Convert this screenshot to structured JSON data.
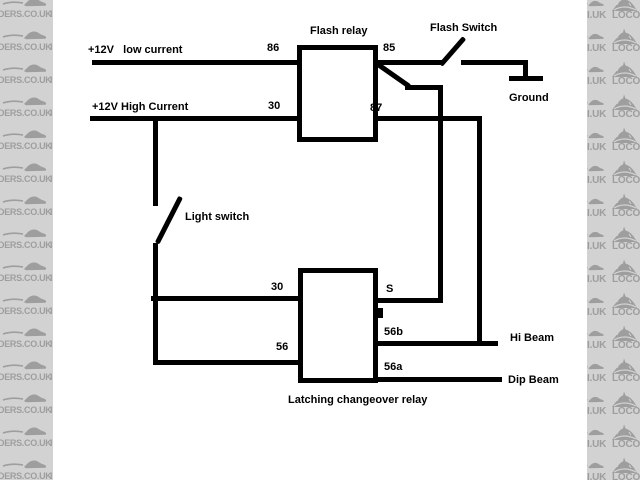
{
  "watermark": {
    "left_text": "DERS.CO.UK",
    "left_fragment": "I",
    "right_tail_text": "I.UK",
    "right_brand_text": "LOCOST",
    "rows": 15,
    "strip_bg": "#d2d2d2",
    "ink": "#9e9e9e"
  },
  "diagram": {
    "labels": {
      "low_current": "+12V   low current",
      "high_current": "+12V High Current",
      "flash_relay": "Flash relay",
      "flash_switch": "Flash Switch",
      "ground": "Ground",
      "light_switch": "Light switch",
      "latching_relay": "Latching changeover relay",
      "hi_beam": "Hi Beam",
      "dip_beam": "Dip Beam"
    },
    "terminals": {
      "t86": "86",
      "t30_top": "30",
      "t85": "85",
      "t87": "87",
      "t30_low": "30",
      "t56": "56",
      "tS": "S",
      "t56b": "56b",
      "t56a": "56a"
    },
    "wire_color": "#000000"
  }
}
